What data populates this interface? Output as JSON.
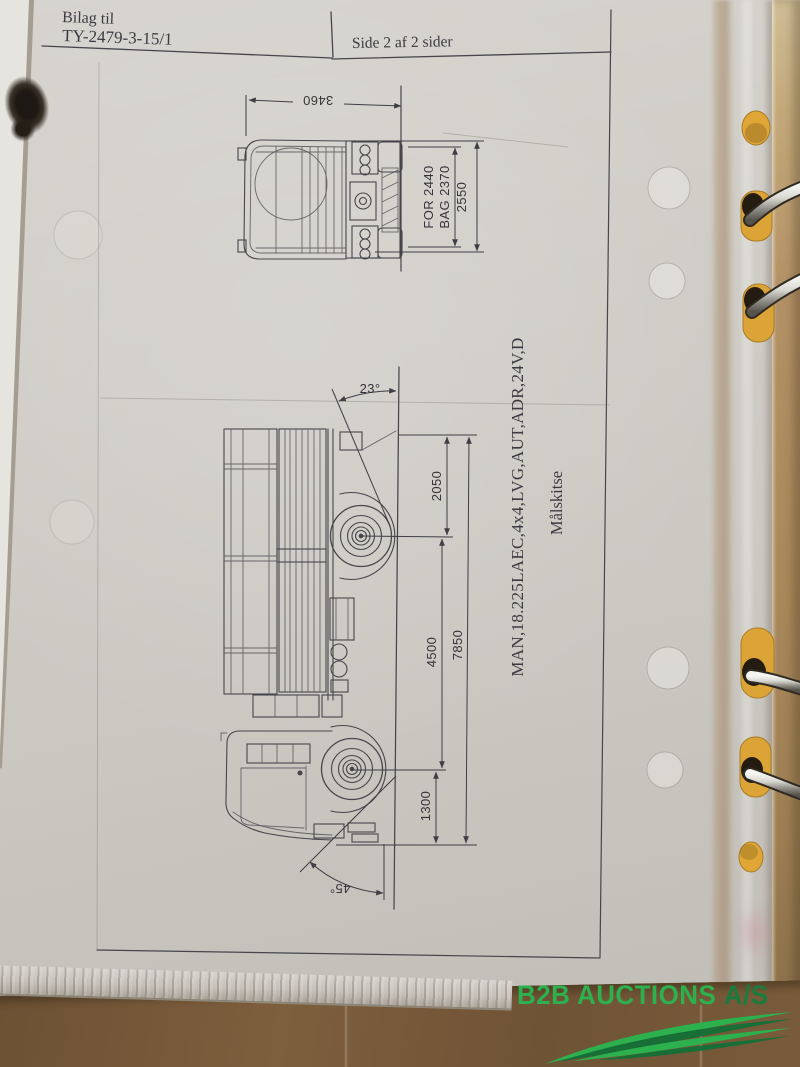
{
  "binder_photo": {
    "header": {
      "attachment_label": "Bilag til",
      "attachment_number": "TY-2479-3-15/1",
      "page_info": "Side 2 af 2 sider"
    },
    "drawing": {
      "title": "Målskitse",
      "vehicle": "MAN,18.225LAEC,4x4,LVG,AUT,ADR,24V,D",
      "front_view": {
        "overall_height": "3460",
        "overall_width": "2550",
        "track_front": "FOR 2440",
        "track_rear": "BAG 2370"
      },
      "side_view": {
        "rear_overhang": "2050",
        "wheelbase": "4500",
        "front_overhang": "1300",
        "overall_length": "7850",
        "departure_angle": "23°",
        "approach_angle": "45°"
      }
    },
    "watermark": {
      "main": "B2B AUCTIONS",
      "suffix": "A/S",
      "color_main": "#2cb14e",
      "color_suffix": "#1b7a3d"
    }
  }
}
